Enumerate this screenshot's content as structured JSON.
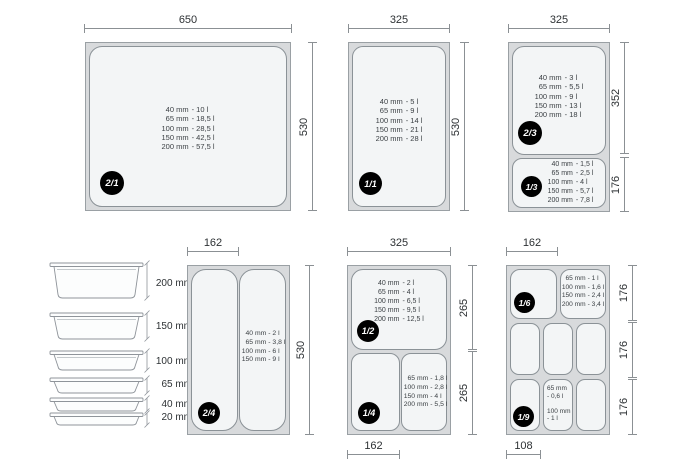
{
  "colors": {
    "pan_outer": "#d8dadc",
    "pan_inner": "#f3f5f6",
    "pan_border": "#8b9297",
    "dim_line": "#8b9094",
    "text": "#33383c",
    "badge_bg": "#000000",
    "badge_text": "#ffffff"
  },
  "dims": {
    "g1": {
      "top": "650",
      "right": "530"
    },
    "g2": {
      "top": "325",
      "right": "530"
    },
    "g3": {
      "top": "325",
      "right1": "352",
      "right2": "176"
    },
    "g4": {
      "top": "162",
      "right": "530"
    },
    "g5": {
      "top": "325",
      "right1": "265",
      "right2": "265",
      "bottom": "162"
    },
    "g6": {
      "top": "162",
      "right1": "176",
      "right2": "176",
      "right3": "176",
      "bottom": "108"
    }
  },
  "pans": {
    "p21": {
      "badge": "2/1",
      "cap": [
        {
          "mm": "40 mm",
          "val": "- 10 l"
        },
        {
          "mm": "65 mm",
          "val": "- 18,5 l"
        },
        {
          "mm": "100 mm",
          "val": "- 28,5 l"
        },
        {
          "mm": "150 mm",
          "val": "- 42,5 l"
        },
        {
          "mm": "200 mm",
          "val": "- 57,5 l"
        }
      ]
    },
    "p11": {
      "badge": "1/1",
      "cap": [
        {
          "mm": "40 mm",
          "val": "- 5 l"
        },
        {
          "mm": "65 mm",
          "val": "- 9 l"
        },
        {
          "mm": "100 mm",
          "val": "- 14 l"
        },
        {
          "mm": "150 mm",
          "val": "- 21 l"
        },
        {
          "mm": "200 mm",
          "val": "- 28 l"
        }
      ]
    },
    "p23": {
      "badge": "2/3",
      "cap": [
        {
          "mm": "40 mm",
          "val": "- 3 l"
        },
        {
          "mm": "65 mm",
          "val": "- 5,5 l"
        },
        {
          "mm": "100 mm",
          "val": "- 9 l"
        },
        {
          "mm": "150 mm",
          "val": "- 13 l"
        },
        {
          "mm": "200 mm",
          "val": "- 18 l"
        }
      ]
    },
    "p13": {
      "badge": "1/3",
      "cap": [
        {
          "mm": "40 mm",
          "val": "- 1,5 l"
        },
        {
          "mm": "65 mm",
          "val": "- 2,5 l"
        },
        {
          "mm": "100 mm",
          "val": "- 4 l"
        },
        {
          "mm": "150 mm",
          "val": "- 5,7 l"
        },
        {
          "mm": "200 mm",
          "val": "- 7,8 l"
        }
      ]
    },
    "p24": {
      "badge": "2/4",
      "cap": [
        {
          "mm": "40 mm",
          "val": "- 2 l"
        },
        {
          "mm": "65 mm",
          "val": "- 3,8 l"
        },
        {
          "mm": "100 mm",
          "val": "- 6 l"
        },
        {
          "mm": "150 mm",
          "val": "- 9 l"
        }
      ]
    },
    "p12": {
      "badge": "1/2",
      "cap": [
        {
          "mm": "40 mm",
          "val": "- 2 l"
        },
        {
          "mm": "65 mm",
          "val": "- 4 l"
        },
        {
          "mm": "100 mm",
          "val": "- 6,5 l"
        },
        {
          "mm": "150 mm",
          "val": "- 9,5 l"
        },
        {
          "mm": "200 mm",
          "val": "- 12,5 l"
        }
      ]
    },
    "p14": {
      "badge": "1/4",
      "cap": [
        {
          "mm": "65 mm",
          "val": "- 1,8 l"
        },
        {
          "mm": "100 mm",
          "val": "- 2,8 l"
        },
        {
          "mm": "150 mm",
          "val": "- 4 l"
        },
        {
          "mm": "200 mm",
          "val": "- 5,5 l"
        }
      ]
    },
    "p16": {
      "badge": "1/6",
      "cap": [
        {
          "mm": "65 mm",
          "val": "- 1 l"
        },
        {
          "mm": "100 mm",
          "val": "- 1,6 l"
        },
        {
          "mm": "150 mm",
          "val": "- 2,4 l"
        },
        {
          "mm": "200 mm",
          "val": "- 3,4 l"
        }
      ]
    },
    "p19": {
      "badge": "1/9",
      "cap_lines": [
        "65 mm",
        "- 0,6 l",
        "100 mm",
        "- 1 l"
      ]
    }
  },
  "stack": {
    "labels": [
      "200 mm",
      "150 mm",
      "100 mm",
      "65 mm",
      "40 mm",
      "20 mm"
    ]
  }
}
